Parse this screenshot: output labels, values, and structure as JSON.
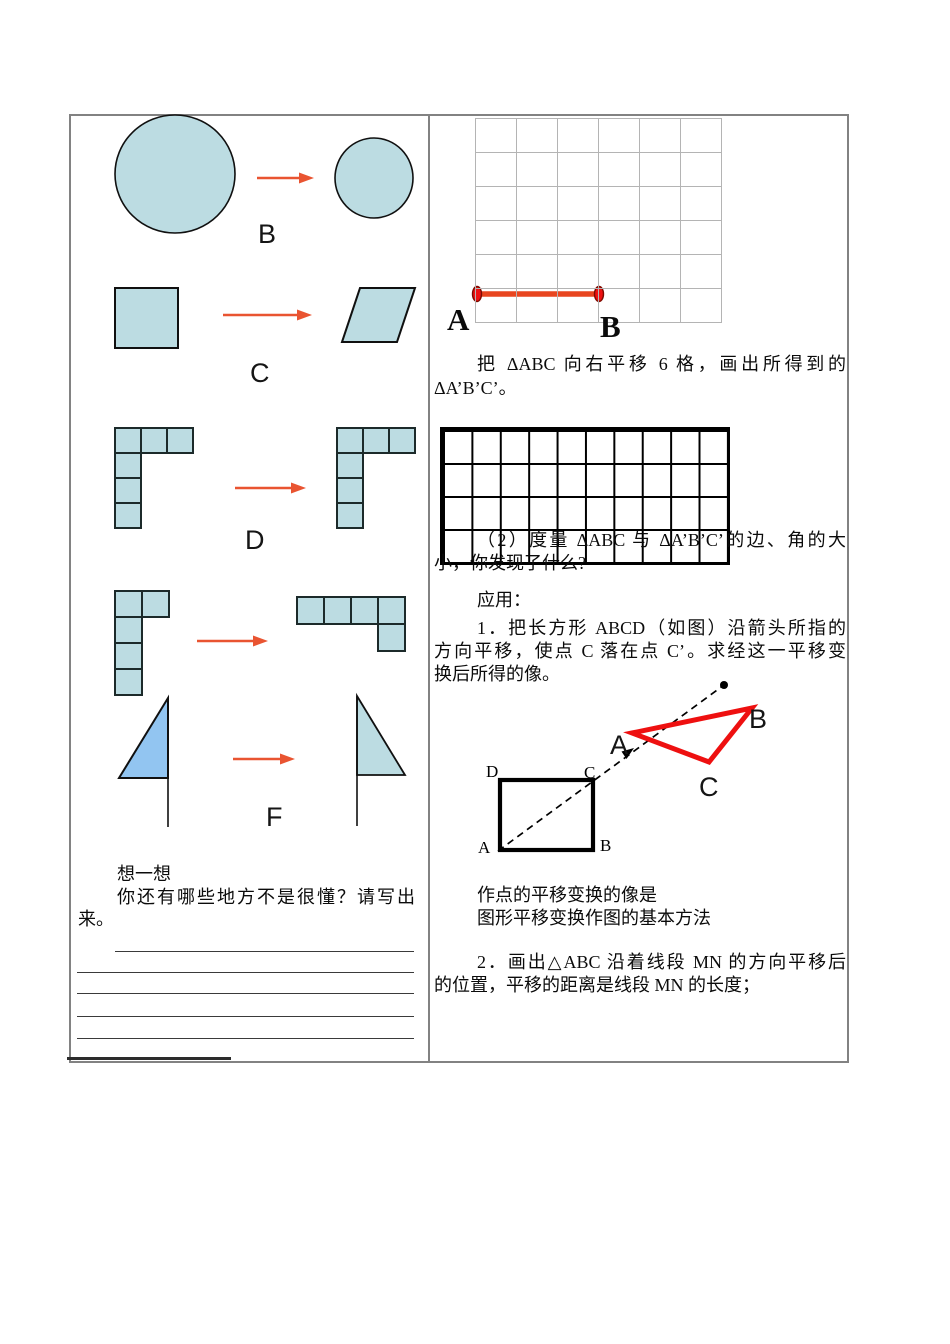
{
  "colors": {
    "shape_fill": "#bcdce2",
    "flag_fill": "#92c5f1",
    "arrow": "#e95431",
    "segment": "#e8451f",
    "endpoint_fill": "#ee1111",
    "endpoint_stroke": "#7d0b00",
    "red_triangle": "#ee1010",
    "grid_line_light": "#b4b4b4",
    "grid_line_bold": "#000000",
    "table_border": "#828282"
  },
  "left": {
    "labels": {
      "b": "B",
      "c": "C",
      "d": "D",
      "f": "F"
    },
    "think_title": "想一想",
    "think_line1": "你还有哪些地方不是很懂？请写出",
    "think_line2": "来。"
  },
  "right": {
    "grid_label_a": "A",
    "grid_label_b": "B",
    "para1_line1": "把 ΔABC 向右平移 6 格，画出所得到的",
    "para1_line2": "ΔA’B’C’。",
    "para2_line1": "（2）度量 ΔABC 与 ΔA’B’C’的边、角的大",
    "para2_line2": "小，你发现了什么?",
    "apply_heading": "应用：",
    "item1_line1": "1．把长方形 ABCD（如图）沿箭头所指的",
    "item1_line2": "方向平移，使点 C 落在点 C’。求经这一平移变",
    "item1_line3": "换后所得的像。",
    "square_labels": {
      "d": "D",
      "c": "C",
      "a": "A",
      "b": "B"
    },
    "triangle_labels": {
      "a": "A",
      "b": "B",
      "c": "C"
    },
    "method_line1": "作点的平移变换的像是",
    "method_line2": "图形平移变换作图的基本方法",
    "item2_line1": "2．画出△ABC 沿着线段 MN 的方向平移后",
    "item2_line2": "的位置，平移的距离是线段 MN 的长度；"
  }
}
